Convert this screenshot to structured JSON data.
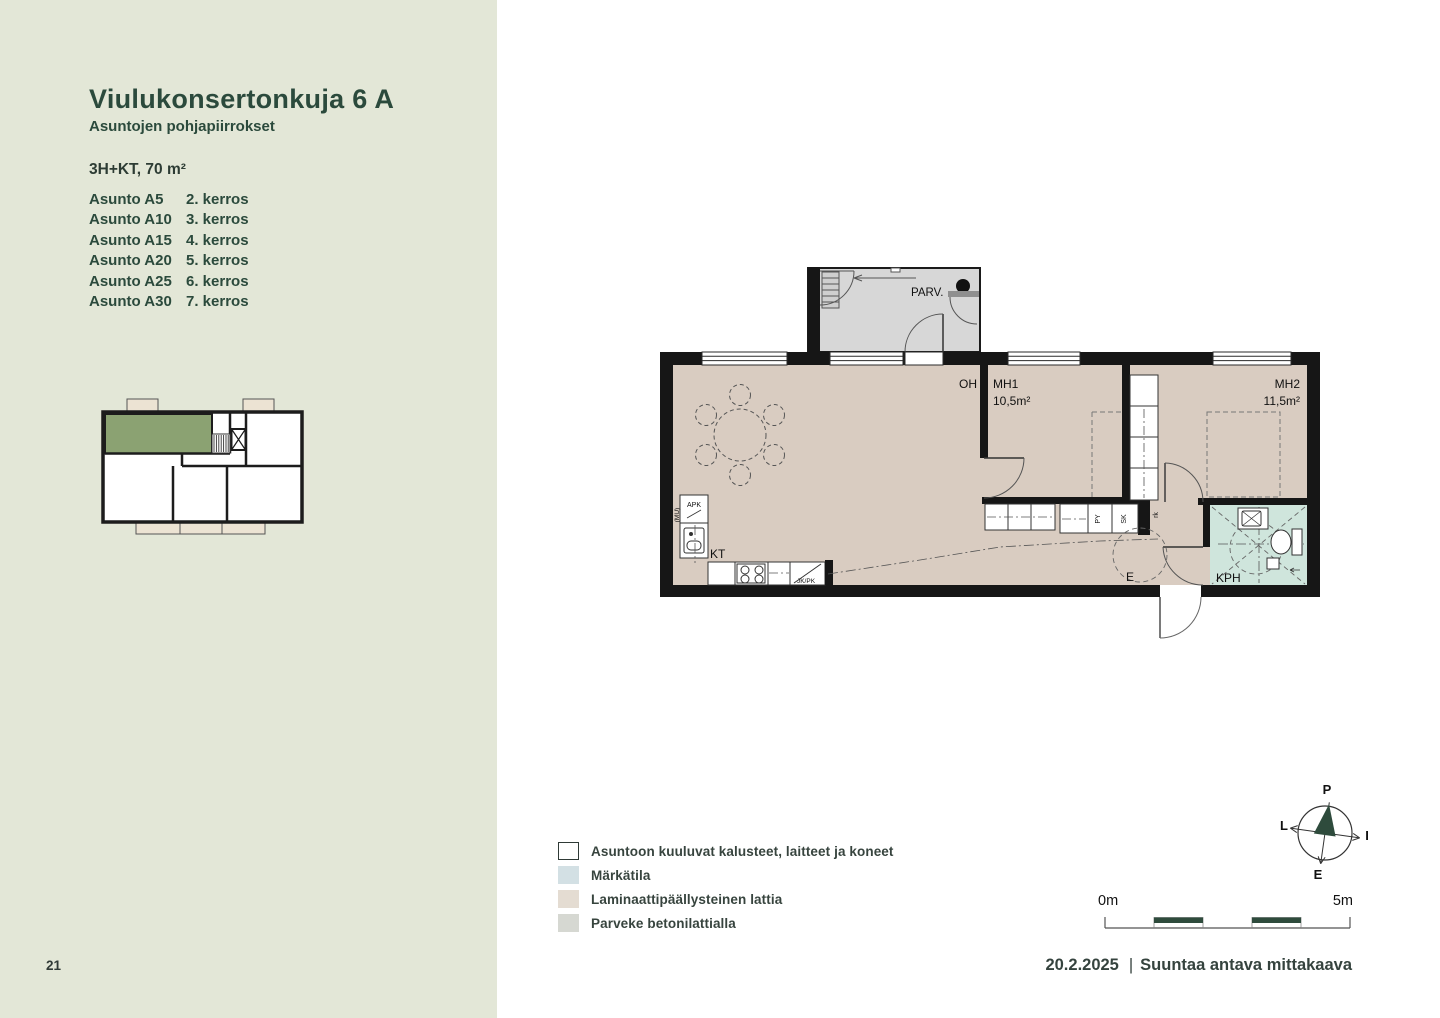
{
  "page": {
    "number": "21"
  },
  "sidebar": {
    "title": "Viulukonsertonkuja 6 A",
    "subtitle": "Asuntojen pohjapiirrokset",
    "unit_type": "3H+KT, 70 m²",
    "apartments": [
      {
        "name": "Asunto A5",
        "floor": "2. kerros"
      },
      {
        "name": "Asunto A10",
        "floor": "3. kerros"
      },
      {
        "name": "Asunto A15",
        "floor": "4. kerros"
      },
      {
        "name": "Asunto A20",
        "floor": "5. kerros"
      },
      {
        "name": "Asunto A25",
        "floor": "6. kerros"
      },
      {
        "name": "Asunto A30",
        "floor": "7. kerros"
      }
    ]
  },
  "floorplan": {
    "labels": {
      "balcony": "PARV.",
      "living_room": "OH",
      "bedroom1": "MH1",
      "bedroom1_area": "10,5m²",
      "bedroom2": "MH2",
      "bedroom2_area": "11,5m²",
      "kitchen": "KT",
      "bathroom": "KPH",
      "entrance": "E",
      "dishwasher": "APK",
      "mu": "(MU)",
      "fridge_freezer": "JK/PK",
      "py": "PY",
      "sk": "SK",
      "rk": "rk"
    },
    "colors": {
      "wall": "#161616",
      "laminate_floor": "#d9ccc1",
      "wet_room_floor": "#cfe5dc",
      "balcony_floor": "#d7d7d7",
      "key_plan_highlight": "#8ba272",
      "key_plan_balcony": "#ece3d3"
    }
  },
  "legend": {
    "items": [
      {
        "label": "Asuntoon kuuluvat kalusteet, laitteet ja koneet",
        "color": "#ffffff",
        "bordered": true
      },
      {
        "label": "Märkätila",
        "color": "#d3e0e4"
      },
      {
        "label": "Laminaattipäällysteinen lattia",
        "color": "#e4dcd2"
      },
      {
        "label": "Parveke betonilattialla",
        "color": "#d6d8d2"
      }
    ]
  },
  "compass": {
    "north": "P",
    "east": "I",
    "south": "E",
    "west": "L",
    "needle_color": "#2e4b3c"
  },
  "scale_bar": {
    "start_label": "0m",
    "end_label": "5m",
    "segment_color": "#2e4b3c"
  },
  "footer": {
    "date": "20.2.2025",
    "separator": "|",
    "note": "Suuntaa antava mittakaava"
  }
}
